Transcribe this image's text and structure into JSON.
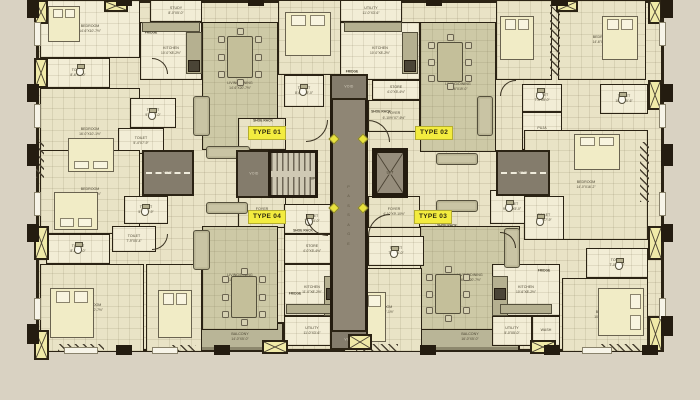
{
  "palette": {
    "wall": "#2b2314",
    "background": "#d9d2c2",
    "floor_cream": "#f2edd6",
    "floor_tile": "#e9e3c6",
    "floor_khaki": "#cdc9a6",
    "balcony_olive": "#b9b597",
    "passage_grey": "#8f8675",
    "void_grey": "#847c6c",
    "accent_yellow": "#f3ec3f",
    "duct_yellow": "#f0eaa8",
    "label_text": "#4d4734"
  },
  "core": {
    "passage_label": "PASSAGE",
    "lift_label": "LIFT",
    "void_label": "VOID",
    "up_label": "UP"
  },
  "type_labels": [
    {
      "label": "TYPE 01",
      "x": 248,
      "y": 126
    },
    {
      "label": "TYPE 02",
      "x": 415,
      "y": 126
    },
    {
      "label": "TYPE 03",
      "x": 414,
      "y": 210
    },
    {
      "label": "TYPE 04",
      "x": 248,
      "y": 210
    }
  ],
  "rooms": [
    {
      "n": "BALCONY",
      "d": "14'-0\"X5'-0\"",
      "x": 196,
      "y": 322,
      "w": 88,
      "h": 30,
      "f": "olive"
    },
    {
      "n": "BALCONY",
      "d": "16'-0\"X5'-0\"",
      "x": 420,
      "y": 322,
      "w": 100,
      "h": 30,
      "f": "olive"
    },
    {
      "n": "BEDROOM",
      "d": "14'-6\"X10'-7½\"",
      "x": 40,
      "y": 0,
      "w": 100,
      "h": 58,
      "f": "cream"
    },
    {
      "n": "TOILET",
      "d": "8'-6\"X5'-0\"",
      "x": 46,
      "y": 58,
      "w": 64,
      "h": 30,
      "f": "cream"
    },
    {
      "n": "STUDY",
      "d": "8'-0\"X5'-0\"",
      "x": 150,
      "y": 0,
      "w": 52,
      "h": 22,
      "f": "cream"
    },
    {
      "n": "KITCHEN",
      "d": "10'-0\"X8'-2½\"",
      "x": 140,
      "y": 22,
      "w": 62,
      "h": 58,
      "f": "cream"
    },
    {
      "n": "LIVING/DINING",
      "d": "14'-6\"X20'-7½\"",
      "x": 202,
      "y": 22,
      "w": 76,
      "h": 128,
      "f": "khaki"
    },
    {
      "n": "BEDROOM",
      "d": "16'-0\"X10'-1½\"",
      "x": 40,
      "y": 88,
      "w": 100,
      "h": 88,
      "f": "tile"
    },
    {
      "n": "TOILET",
      "d": "9'-2\"X5'-0\"",
      "x": 130,
      "y": 98,
      "w": 46,
      "h": 30,
      "f": "cream"
    },
    {
      "n": "TOILET",
      "d": "5'-4\"X7'-9\"",
      "x": 118,
      "y": 128,
      "w": 46,
      "h": 26,
      "f": "cream"
    },
    {
      "n": "BEDROOM",
      "d": "11'-0\"X12'-2\"",
      "x": 278,
      "y": 0,
      "w": 64,
      "h": 75,
      "f": "tile"
    },
    {
      "n": "TOILET",
      "d": "8'-6½\"X5'-0\"",
      "x": 284,
      "y": 75,
      "w": 40,
      "h": 32,
      "f": "cream"
    },
    {
      "n": "FOYER",
      "d": "6'-10½\"X6'-6\"",
      "x": 238,
      "y": 118,
      "w": 48,
      "h": 32,
      "f": "tile"
    },
    {
      "n": "UTILITY",
      "d": "11'-0\"X3'-6\"",
      "x": 340,
      "y": 0,
      "w": 62,
      "h": 22,
      "f": "cream"
    },
    {
      "n": "KITCHEN",
      "d": "10'-0\"X8'-2½\"",
      "x": 340,
      "y": 22,
      "w": 80,
      "h": 58,
      "f": "cream"
    },
    {
      "n": "STORE",
      "d": "4'-0\"X5'-4½\"",
      "x": 372,
      "y": 80,
      "w": 48,
      "h": 20,
      "f": "cream"
    },
    {
      "n": "FOYER",
      "d": "6'-10½\"X7'-6½\"",
      "x": 368,
      "y": 100,
      "w": 52,
      "h": 32,
      "f": "tile"
    },
    {
      "n": "LIVING/DINING",
      "d": "16'-6\"X19'-0\"",
      "x": 420,
      "y": 22,
      "w": 76,
      "h": 130,
      "f": "khaki"
    },
    {
      "n": "BEDROOM",
      "d": "10'-0\"X12'-0\"",
      "x": 496,
      "y": 0,
      "w": 56,
      "h": 80,
      "f": "tile"
    },
    {
      "n": "BEDROOM",
      "d": "14'-6\"X10'-0\"",
      "x": 558,
      "y": 0,
      "w": 88,
      "h": 80,
      "f": "tile"
    },
    {
      "n": "TOILET",
      "d": "10'-2\"X5'-6\"",
      "x": 600,
      "y": 84,
      "w": 48,
      "h": 30,
      "f": "cream"
    },
    {
      "n": "TOILET",
      "d": "7'-4\"X5'-0\"",
      "x": 522,
      "y": 84,
      "w": 40,
      "h": 28,
      "f": "cream"
    },
    {
      "n": "PUJA",
      "d": "5'-0\"X5'-1\"",
      "x": 522,
      "y": 112,
      "w": 40,
      "h": 38,
      "f": "cream"
    },
    {
      "n": "BEDROOM",
      "d": "14'-0\"X16'-2\"",
      "x": 524,
      "y": 130,
      "w": 124,
      "h": 110,
      "f": "tile"
    },
    {
      "n": "TOILET",
      "d": "9'-1½\"X5'-0\"",
      "x": 490,
      "y": 190,
      "w": 44,
      "h": 34,
      "f": "cream"
    },
    {
      "n": "TOILET",
      "d": "5'-2\"X7'-9\"",
      "x": 524,
      "y": 196,
      "w": 40,
      "h": 44,
      "f": "cream"
    },
    {
      "n": "FOYER",
      "d": "4'-10\"X9'-10½\"",
      "x": 368,
      "y": 196,
      "w": 52,
      "h": 32,
      "f": "tile"
    },
    {
      "n": "LIVING/DINING",
      "d": "16'-6\"X20'-7½\"",
      "x": 420,
      "y": 226,
      "w": 100,
      "h": 104,
      "f": "khaki"
    },
    {
      "n": "BEDROOM",
      "d": "11'-0\"X12'-1½\"",
      "x": 344,
      "y": 268,
      "w": 78,
      "h": 84,
      "f": "tile"
    },
    {
      "n": "TOILET",
      "d": "7'-6\"X5'-0\"",
      "x": 368,
      "y": 236,
      "w": 56,
      "h": 30,
      "f": "cream"
    },
    {
      "n": "KITCHEN",
      "d": "10'-6\"X8'-2½\"",
      "x": 492,
      "y": 264,
      "w": 68,
      "h": 52,
      "f": "cream"
    },
    {
      "n": "UTILITY",
      "d": "5'-0\"X5'-0\"",
      "x": 492,
      "y": 316,
      "w": 40,
      "h": 30,
      "f": "cream"
    },
    {
      "n": "WASH",
      "d": "",
      "x": 532,
      "y": 316,
      "w": 28,
      "h": 30,
      "f": "cream"
    },
    {
      "n": "BEDROOM",
      "d": "10'-0\"X11'-7½\"",
      "x": 562,
      "y": 278,
      "w": 86,
      "h": 74,
      "f": "tile"
    },
    {
      "n": "TOILET",
      "d": "7'-0\"X5'-0\"",
      "x": 586,
      "y": 248,
      "w": 62,
      "h": 30,
      "f": "cream"
    },
    {
      "n": "FOYER",
      "d": "6'-10\"X6'-6\"",
      "x": 238,
      "y": 196,
      "w": 48,
      "h": 32,
      "f": "tile"
    },
    {
      "n": "LIVING/DINING",
      "d": "16'-6\"X20'-7½\"",
      "x": 202,
      "y": 226,
      "w": 76,
      "h": 104,
      "f": "khaki"
    },
    {
      "n": "TOILET",
      "d": "7'-6\"X5'-0\"",
      "x": 284,
      "y": 204,
      "w": 56,
      "h": 30,
      "f": "cream"
    },
    {
      "n": "STORE",
      "d": "4'-0\"X5'-4½\"",
      "x": 284,
      "y": 234,
      "w": 56,
      "h": 30,
      "f": "cream"
    },
    {
      "n": "KITCHEN",
      "d": "11'-0\"X8'-2½\"",
      "x": 284,
      "y": 264,
      "w": 56,
      "h": 52,
      "f": "cream"
    },
    {
      "n": "UTILITY",
      "d": "11'-0\"X3'-6\"",
      "x": 284,
      "y": 316,
      "w": 56,
      "h": 30,
      "f": "cream"
    },
    {
      "n": "BEDROOM",
      "d": "16'-6\"X10'-7½\"",
      "x": 40,
      "y": 150,
      "w": 100,
      "h": 84,
      "f": "tile"
    },
    {
      "n": "TOILET",
      "d": "8'-6\"X5'-0\"",
      "x": 46,
      "y": 234,
      "w": 64,
      "h": 30,
      "f": "cream"
    },
    {
      "n": "TOILET",
      "d": "5'-4\"X7'-9\"",
      "x": 124,
      "y": 196,
      "w": 44,
      "h": 28,
      "f": "cream"
    },
    {
      "n": "TOILET",
      "d": "7'-9\"X5'-4\"",
      "x": 112,
      "y": 226,
      "w": 44,
      "h": 26,
      "f": "cream"
    },
    {
      "n": "BEDROOM",
      "d": "14'-6\"X10'-7½\"",
      "x": 40,
      "y": 264,
      "w": 104,
      "h": 88,
      "f": "tile"
    },
    {
      "n": "BEDROOM",
      "d": "10'-0\"X12'-6\"",
      "x": 146,
      "y": 264,
      "w": 56,
      "h": 88,
      "f": "tile"
    }
  ],
  "passage": {
    "x": 330,
    "y": 100,
    "w": 38,
    "h": 230
  },
  "stairs": {
    "x": 268,
    "y": 150,
    "w": 50,
    "h": 48
  },
  "lift": {
    "x": 372,
    "y": 148,
    "w": 36,
    "h": 50
  },
  "voids": [
    [
      142,
      150,
      52,
      46,
      1
    ],
    [
      496,
      150,
      54,
      46,
      1
    ],
    [
      236,
      150,
      36,
      48,
      0
    ],
    [
      330,
      74,
      38,
      26,
      0
    ],
    [
      330,
      330,
      38,
      20,
      0
    ]
  ],
  "diamonds": [
    [
      330,
      135
    ],
    [
      359,
      135
    ],
    [
      330,
      204
    ],
    [
      359,
      204
    ]
  ],
  "beds": [
    [
      48,
      6,
      32,
      36,
      "t"
    ],
    [
      285,
      12,
      46,
      44,
      "t"
    ],
    [
      500,
      16,
      34,
      44,
      "t"
    ],
    [
      602,
      16,
      36,
      44,
      "t"
    ],
    [
      68,
      138,
      46,
      34,
      "b"
    ],
    [
      574,
      134,
      46,
      36,
      "t"
    ],
    [
      54,
      192,
      44,
      38,
      "b"
    ],
    [
      50,
      288,
      44,
      50,
      "t"
    ],
    [
      158,
      290,
      34,
      48,
      "t"
    ],
    [
      348,
      292,
      38,
      50,
      "t"
    ],
    [
      598,
      288,
      46,
      48,
      "r"
    ]
  ],
  "dining_tables": [
    [
      218,
      28,
      44,
      58
    ],
    [
      428,
      34,
      44,
      56
    ],
    [
      222,
      268,
      44,
      58
    ],
    [
      426,
      266,
      44,
      56
    ]
  ],
  "sofas": [
    [
      193,
      96,
      17,
      40
    ],
    [
      206,
      146,
      44,
      13
    ],
    [
      477,
      96,
      16,
      40
    ],
    [
      436,
      153,
      42,
      12
    ],
    [
      193,
      230,
      17,
      40
    ],
    [
      206,
      202,
      42,
      12
    ],
    [
      504,
      228,
      16,
      40
    ],
    [
      436,
      200,
      42,
      12
    ]
  ],
  "wcs": [
    [
      76,
      66
    ],
    [
      148,
      110
    ],
    [
      299,
      86
    ],
    [
      618,
      94
    ],
    [
      536,
      90
    ],
    [
      505,
      202
    ],
    [
      536,
      216
    ],
    [
      390,
      248
    ],
    [
      141,
      206
    ],
    [
      74,
      244
    ],
    [
      615,
      260
    ],
    [
      305,
      216
    ]
  ],
  "counters": [
    [
      142,
      22,
      58,
      10
    ],
    [
      186,
      32,
      16,
      42
    ],
    [
      344,
      22,
      58,
      10
    ],
    [
      402,
      32,
      16,
      42
    ],
    [
      492,
      276,
      16,
      40
    ],
    [
      500,
      304,
      52,
      10
    ],
    [
      324,
      276,
      16,
      40
    ],
    [
      286,
      304,
      52,
      10
    ]
  ],
  "stoves": [
    [
      188,
      60,
      12,
      12
    ],
    [
      404,
      60,
      12,
      12
    ],
    [
      494,
      288,
      12,
      12
    ],
    [
      326,
      288,
      12,
      12
    ]
  ],
  "hatches": [
    [
      58,
      344,
      46,
      7
    ],
    [
      170,
      345,
      26,
      6
    ],
    [
      356,
      344,
      42,
      7
    ],
    [
      600,
      344,
      40,
      7
    ],
    [
      550,
      4,
      10,
      72
    ],
    [
      640,
      142,
      9,
      60
    ],
    [
      36,
      142,
      8,
      36
    ]
  ],
  "xducts": [
    [
      34,
      0,
      14,
      24
    ],
    [
      104,
      0,
      24,
      12
    ],
    [
      556,
      0,
      22,
      12
    ],
    [
      648,
      0,
      14,
      24
    ],
    [
      34,
      58,
      14,
      30
    ],
    [
      648,
      80,
      14,
      30
    ],
    [
      34,
      226,
      15,
      34
    ],
    [
      648,
      226,
      15,
      34
    ],
    [
      34,
      330,
      15,
      30
    ],
    [
      648,
      316,
      15,
      36
    ],
    [
      262,
      340,
      26,
      14
    ],
    [
      348,
      334,
      24,
      16
    ],
    [
      530,
      340,
      26,
      14
    ]
  ],
  "doors": [
    [
      306,
      120,
      22,
      180
    ],
    [
      368,
      120,
      22,
      90
    ],
    [
      306,
      214,
      22,
      270
    ],
    [
      368,
      214,
      22,
      0
    ],
    [
      152,
      58,
      16,
      90
    ],
    [
      152,
      234,
      16,
      180
    ],
    [
      500,
      80,
      16,
      0
    ],
    [
      500,
      232,
      16,
      90
    ]
  ],
  "windows": [
    [
      34,
      22,
      7,
      24
    ],
    [
      34,
      104,
      7,
      24
    ],
    [
      34,
      192,
      7,
      24
    ],
    [
      34,
      298,
      7,
      22
    ],
    [
      659,
      22,
      7,
      24
    ],
    [
      659,
      104,
      7,
      24
    ],
    [
      659,
      192,
      7,
      24
    ],
    [
      659,
      298,
      7,
      22
    ],
    [
      64,
      347,
      34,
      7
    ],
    [
      152,
      347,
      26,
      7
    ],
    [
      582,
      347,
      30,
      7
    ]
  ],
  "columns": [
    [
      27,
      -2,
      12,
      20
    ],
    [
      27,
      84,
      12,
      18
    ],
    [
      27,
      144,
      12,
      22
    ],
    [
      27,
      224,
      12,
      18
    ],
    [
      27,
      324,
      12,
      20
    ],
    [
      661,
      -2,
      12,
      20
    ],
    [
      661,
      84,
      12,
      18
    ],
    [
      661,
      144,
      12,
      22
    ],
    [
      661,
      224,
      12,
      18
    ],
    [
      661,
      316,
      12,
      20
    ],
    [
      116,
      345,
      16,
      10
    ],
    [
      214,
      345,
      16,
      10
    ],
    [
      420,
      345,
      16,
      10
    ],
    [
      544,
      345,
      16,
      10
    ],
    [
      642,
      345,
      16,
      10
    ],
    [
      116,
      -2,
      16,
      8
    ],
    [
      248,
      -2,
      16,
      8
    ],
    [
      426,
      -2,
      16,
      8
    ],
    [
      552,
      -2,
      16,
      8
    ]
  ],
  "tags": [
    [
      "FRIDGE",
      151,
      33
    ],
    [
      "FRIDGE",
      352,
      72
    ],
    [
      "FRIDGE",
      544,
      271
    ],
    [
      "FRIDGE",
      295,
      294
    ],
    [
      "SHOE RACK",
      263,
      121
    ],
    [
      "SHOE RACK",
      381,
      112
    ],
    [
      "SHOE RACK",
      447,
      226
    ],
    [
      "SHOE RACK",
      303,
      231
    ],
    [
      "UP",
      313,
      179
    ]
  ]
}
